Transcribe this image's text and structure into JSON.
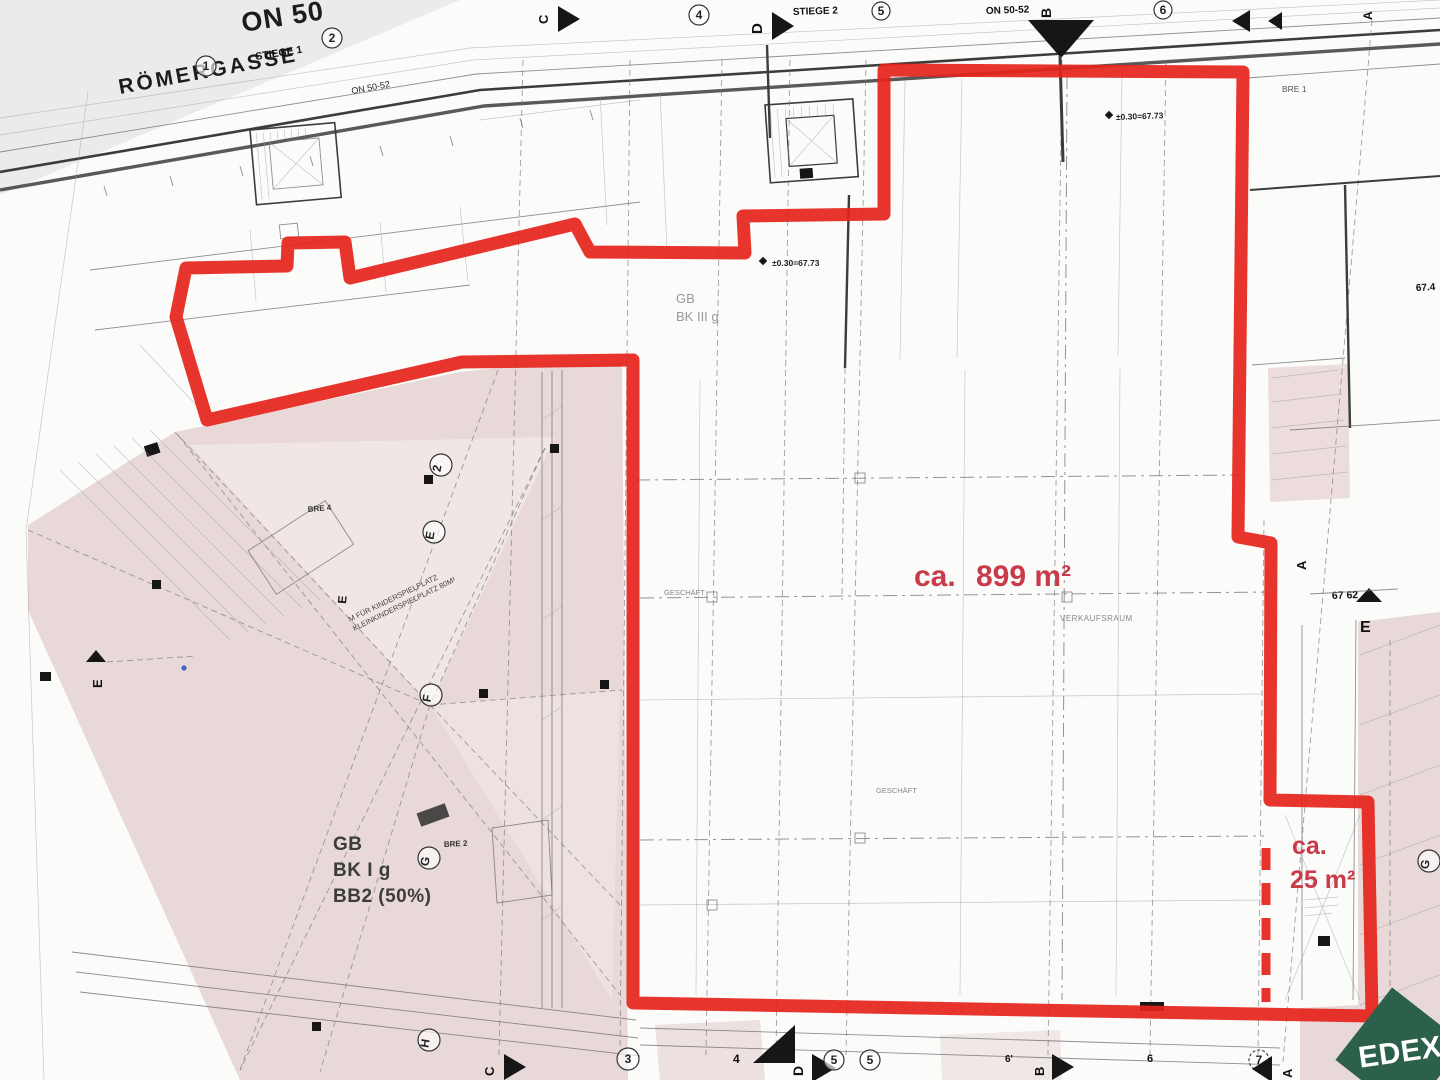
{
  "plan": {
    "title": "ON 50",
    "street": {
      "name": "RÖMERGASSE",
      "number": "ON 50-52"
    },
    "stiege1": "STIEGE 1",
    "stiege2": "STIEGE 2",
    "on5052": "ON 50-52",
    "zone_top": {
      "l1": "GB",
      "l2": "BK III g"
    },
    "zone_court": {
      "l1": "GB",
      "l2": "BK I g",
      "l3": "BB2 (50%)"
    },
    "verkaufsraum": "VERKAUFSRAUM",
    "geschaeft": "GESCHÄFT",
    "bre1": "BRE 1",
    "bre2": "BRE 2",
    "bre4": "BRE 4",
    "elevation": "±0.30=67.73",
    "level_right": "67 62",
    "level_edge": "67.4",
    "playground": {
      "l1": "M FÜR KINDERSPIELPLATZ",
      "l2": "KLEINKINDERSPIELPLATZ 80M²"
    }
  },
  "grid": {
    "top": {
      "n1": "1",
      "n2": "2",
      "n4": "4",
      "n5": "5",
      "n6": "6",
      "c": "C",
      "d": "D",
      "b": "B",
      "a": "A"
    },
    "bottom": {
      "c": "C",
      "n3": "3",
      "n4": "4",
      "d": "D",
      "n5a": "5",
      "n5b": "5",
      "n6p": "6'",
      "b": "B",
      "n6": "6",
      "n7": "7",
      "a": "A"
    },
    "left": {
      "e": "E"
    },
    "right": {
      "a": "A",
      "e": "E",
      "g": "G"
    },
    "court": {
      "n2": "2",
      "e": "E",
      "f": "F",
      "g": "G",
      "h": "H",
      "e2": "E"
    }
  },
  "highlight": {
    "main": {
      "prefix": "ca.",
      "value": "899 m²"
    },
    "small": {
      "prefix": "ca.",
      "value": "25 m²"
    },
    "outline_color": "#e5231b",
    "text_color": "#c93a4a"
  },
  "logo": {
    "text": "EDEX",
    "color": "#2d604a"
  }
}
